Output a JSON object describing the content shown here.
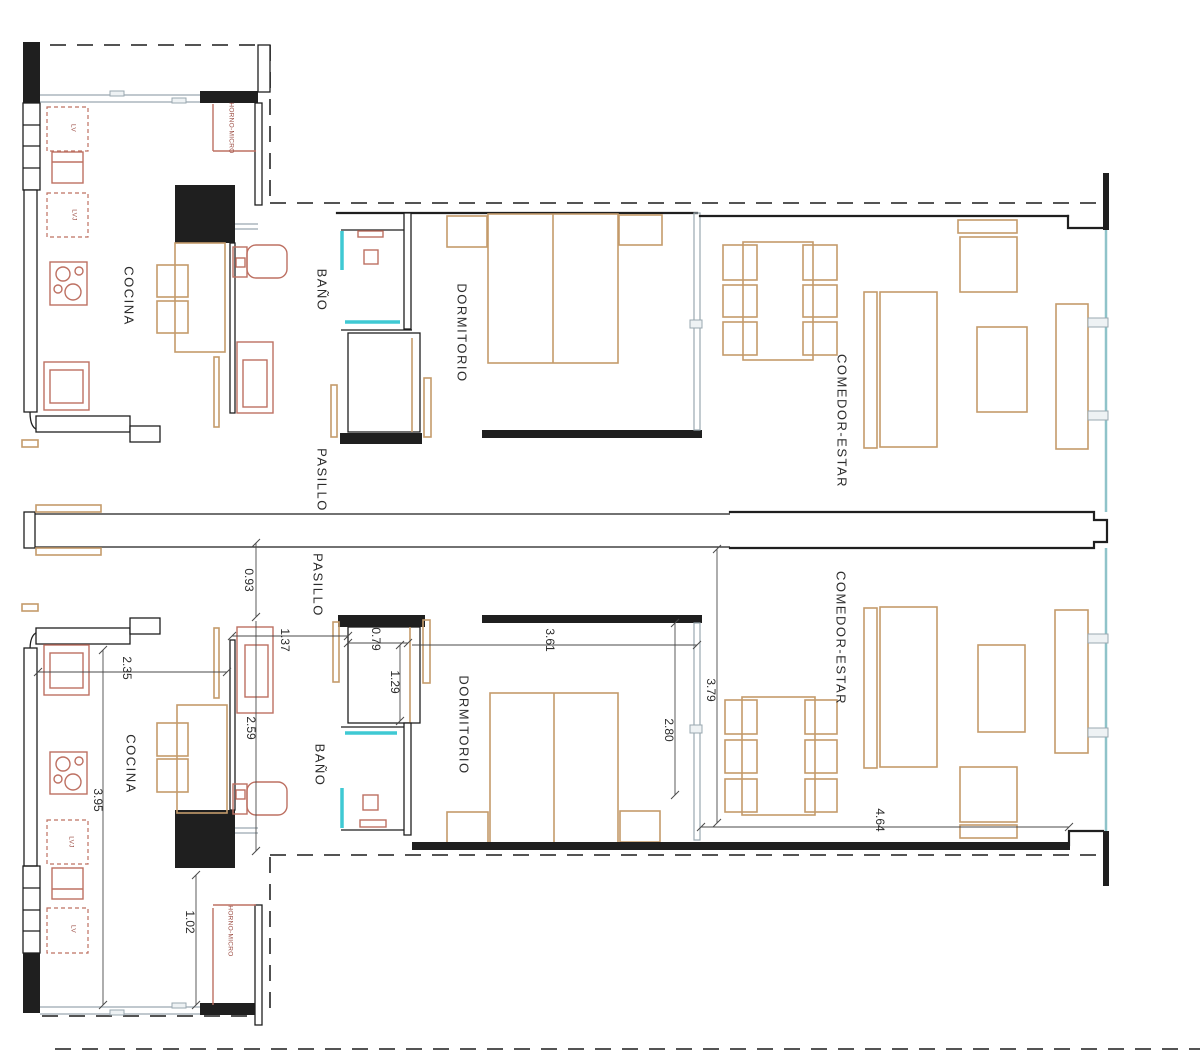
{
  "plan": {
    "rooms": {
      "cocina": "COCINA",
      "bano": "BAÑO",
      "dormitorio": "DORMITORIO",
      "pasillo": "PASILLO",
      "comedor_estar": "COMEDOR-ESTAR"
    },
    "appliances": {
      "lv": "LV",
      "lvj": "LVJ",
      "horno_micro": "HORNO-MICRO"
    },
    "dimensions": {
      "corridor_width": "0.93",
      "entry_width": "1.37",
      "kitchen_width": "2.35",
      "hall_length": "2.59",
      "closet_width": "0.79",
      "closet_depth": "1.29",
      "bedroom_width": "3.61",
      "bedroom_depth": "2.80",
      "living_depth": "3.79",
      "kitchen_length": "3.95",
      "kitchen_opening": "1.02",
      "living_width": "4.64"
    },
    "colors": {
      "wall": "#1f1f1f",
      "furniture": "#c49b6b",
      "fixture": "#bd7062",
      "glass": "#3fc9d3",
      "window_frame": "#9aa8b0",
      "boundary": "#3d3d3d",
      "dimension_text": "#2b2b2b",
      "background": "#ffffff"
    }
  }
}
